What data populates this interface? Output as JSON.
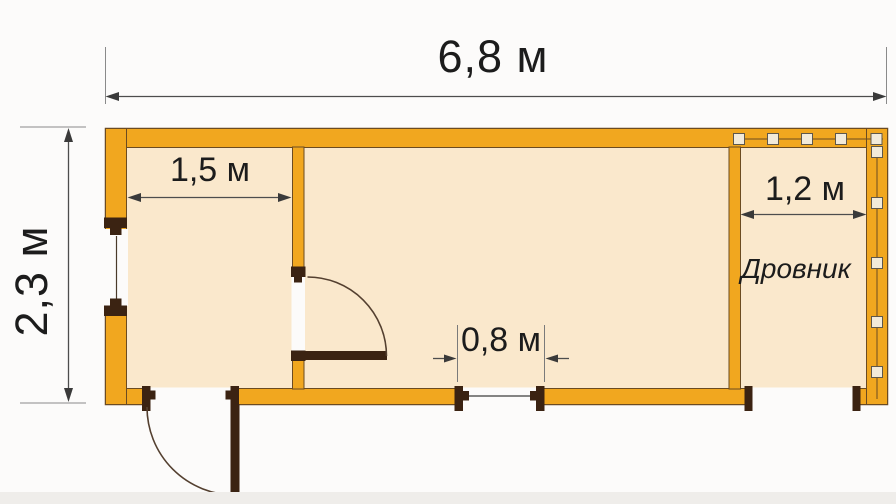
{
  "plan": {
    "type": "floor-plan",
    "units": "м",
    "overall": {
      "width": {
        "label": "6,8 м",
        "value_m": 6.8
      },
      "depth": {
        "label": "2,3 м",
        "value_m": 2.3
      }
    },
    "rooms": [
      {
        "id": "left-room",
        "width": {
          "label": "1,5 м",
          "value_m": 1.5
        }
      },
      {
        "id": "main-room",
        "doorway": {
          "label": "0,8 м",
          "value_m": 0.8
        }
      },
      {
        "id": "woodshed",
        "name": "Дровник",
        "width": {
          "label": "1,2 м",
          "value_m": 1.2
        }
      }
    ],
    "colors": {
      "wall": "#f1a71f",
      "wall_outline": "#6b4b21",
      "floor": "#fae8cc",
      "door_wood": "#3b2312",
      "dimension_line": "#4d4d4d",
      "text": "#1c1c1c",
      "background": "#fcfbfa"
    }
  }
}
